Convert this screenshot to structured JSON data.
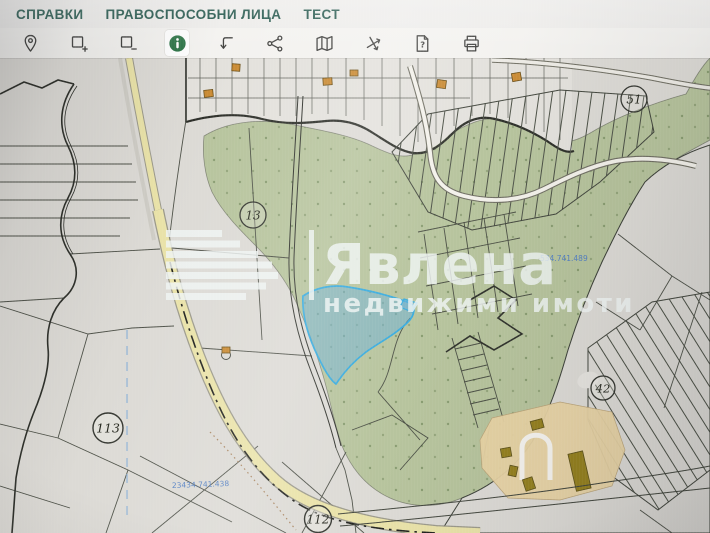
{
  "menu": {
    "items": [
      {
        "label": "СПРАВКИ"
      },
      {
        "label": "ПРАВОСПОСОБНИ ЛИЦА"
      },
      {
        "label": "ТЕСТ"
      }
    ]
  },
  "toolbar": {
    "buttons": [
      {
        "icon": "location-pin",
        "active": false
      },
      {
        "icon": "select-area-add",
        "active": false
      },
      {
        "icon": "select-area-remove",
        "active": false
      },
      {
        "icon": "info",
        "active": true
      },
      {
        "icon": "bent-arrow",
        "active": false
      },
      {
        "icon": "share-nodes",
        "active": false
      },
      {
        "icon": "folded-map",
        "active": false
      },
      {
        "icon": "crossing-roads",
        "active": false
      },
      {
        "icon": "document-question",
        "active": false
      },
      {
        "icon": "printer",
        "active": false
      }
    ]
  },
  "map": {
    "zones": [
      {
        "label": "13"
      },
      {
        "label": "51"
      },
      {
        "label": "113"
      },
      {
        "label": "112"
      },
      {
        "label": "42"
      }
    ],
    "cadastral_ids": [
      {
        "text": "23434.741.438"
      },
      {
        "text": "534.741.489"
      }
    ],
    "watermark": {
      "brand": "Явлена",
      "tagline": "недвижими имоти"
    },
    "colors": {
      "menu_text": "#1f5348",
      "active_icon_green": "#2e7548",
      "parcel_highlight": "#35aade",
      "greenery": "#b6c39c",
      "road_yellow": "#e9e2a8"
    }
  }
}
